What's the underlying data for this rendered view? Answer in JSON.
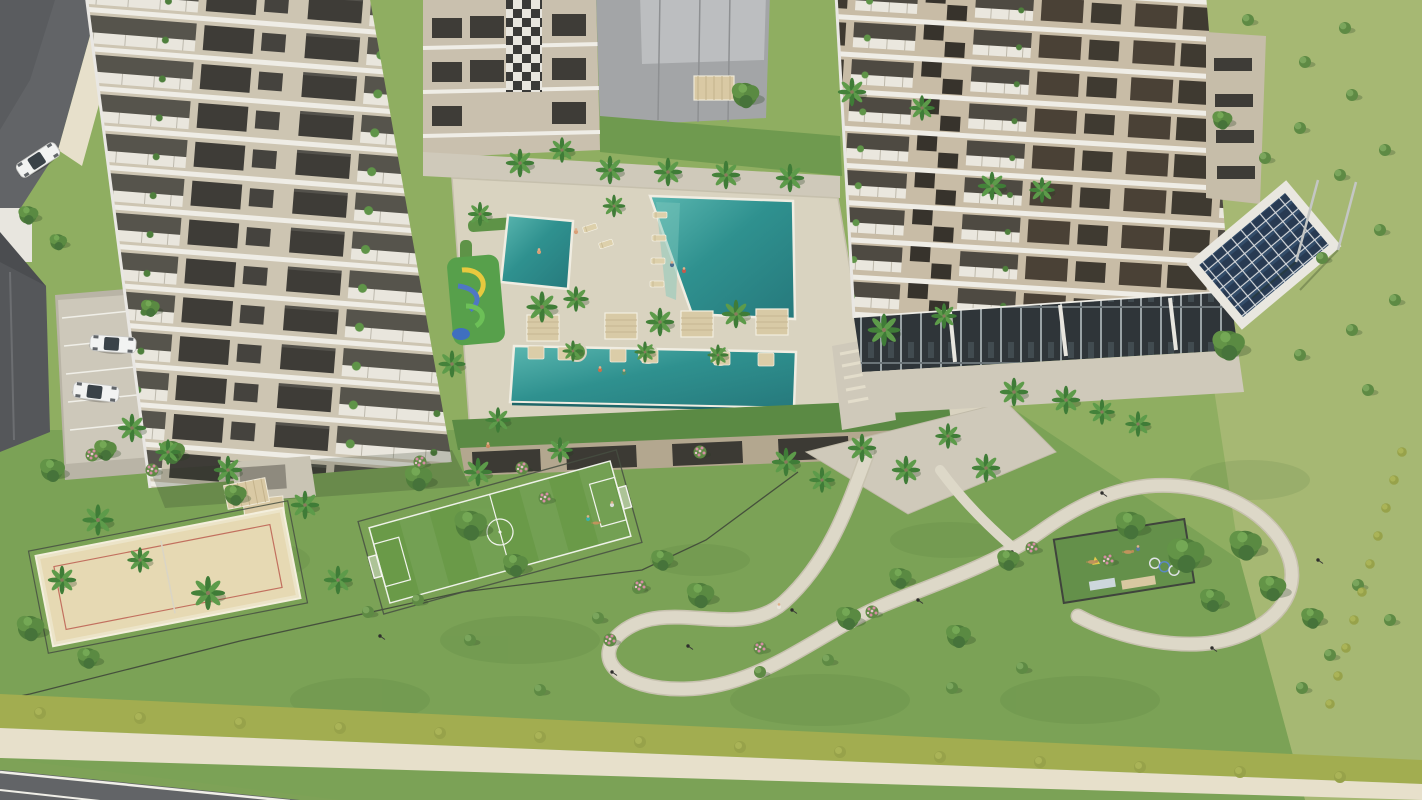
{
  "palette": {
    "grass_base": "#8fae61",
    "grass_light": "#a6b873",
    "grass_garden": "#7ba256",
    "field_green": "#6a9a48",
    "water_light": "#5bb7b0",
    "water_mid": "#2f918f",
    "water_deep": "#26797c",
    "deck": "#d9d3c0",
    "paving": "#cfc9ba",
    "sidewalk": "#e7e0cb",
    "asphalt": "#626467",
    "hedge": "#a2ad50",
    "sand": "#e6d9b3",
    "sand_line": "#c2705f",
    "facade_left": "#cdc5b2",
    "facade_right": "#c8bca6",
    "slab_white": "#efede6",
    "window_dark": "#3e3c37",
    "window_brown": "#4a4136",
    "roof_gray": "#a3a5a7",
    "solar_panel": "#283a52",
    "tan": "#d8caa6",
    "fence": "#474f42",
    "palm_green": "#3f7c37",
    "tree_green": "#4f7d3b",
    "flower_pink": "#d58da4",
    "car_white": "#f2f3f2"
  },
  "scene": {
    "description": "Aerial 3D render of a residential condominium: two beige apartment towers, pool deck with three turquoise pools and a kids water playground with rainbow slide, palm gardens, soccer field, beach volleyball court, dog park, winding walking path, rooftop solar panels and a perimeter road.",
    "vegetation": {
      "palms": [
        [
          520,
          163
        ],
        [
          562,
          150,
          0.9
        ],
        [
          610,
          170
        ],
        [
          668,
          172
        ],
        [
          726,
          175
        ],
        [
          790,
          178
        ],
        [
          992,
          186
        ],
        [
          1042,
          190,
          0.9
        ],
        [
          480,
          214,
          0.85
        ],
        [
          614,
          206,
          0.8
        ],
        [
          542,
          307,
          1.1
        ],
        [
          452,
          364,
          0.95
        ],
        [
          576,
          299,
          0.9
        ],
        [
          660,
          322
        ],
        [
          736,
          314
        ],
        [
          884,
          330,
          1.15
        ],
        [
          944,
          316,
          0.9
        ],
        [
          573,
          351,
          0.75
        ],
        [
          645,
          352,
          0.75
        ],
        [
          718,
          355,
          0.75
        ],
        [
          1014,
          392
        ],
        [
          1066,
          400
        ],
        [
          1102,
          412,
          0.9
        ],
        [
          1138,
          424,
          0.9
        ],
        [
          132,
          428
        ],
        [
          168,
          452,
          0.9
        ],
        [
          228,
          470
        ],
        [
          305,
          505
        ],
        [
          98,
          520,
          1.1
        ],
        [
          140,
          560,
          0.9
        ],
        [
          62,
          580
        ],
        [
          208,
          593,
          1.2
        ],
        [
          338,
          580
        ],
        [
          478,
          472
        ],
        [
          560,
          450,
          0.9
        ],
        [
          786,
          462
        ],
        [
          822,
          480,
          0.9
        ],
        [
          862,
          448
        ],
        [
          906,
          470
        ],
        [
          948,
          436,
          0.9
        ],
        [
          986,
          468
        ],
        [
          498,
          420,
          0.9
        ],
        [
          852,
          92
        ],
        [
          922,
          108,
          0.9
        ]
      ],
      "trees": [
        [
          52,
          470
        ],
        [
          105,
          450,
          0.9
        ],
        [
          172,
          452
        ],
        [
          235,
          495,
          0.9
        ],
        [
          418,
          478,
          1.1
        ],
        [
          470,
          525,
          1.3
        ],
        [
          515,
          565
        ],
        [
          700,
          595,
          1.1
        ],
        [
          662,
          560,
          0.9
        ],
        [
          848,
          618
        ],
        [
          900,
          578,
          0.9
        ],
        [
          958,
          636
        ],
        [
          1008,
          560,
          0.9
        ],
        [
          1130,
          525,
          1.2
        ],
        [
          1185,
          555,
          1.5
        ],
        [
          1245,
          545,
          1.3
        ],
        [
          1272,
          588,
          1.1
        ],
        [
          1212,
          600
        ],
        [
          1312,
          618,
          0.9
        ],
        [
          28,
          215,
          0.8
        ],
        [
          58,
          242,
          0.7
        ],
        [
          30,
          628,
          1.1
        ],
        [
          88,
          658,
          0.9
        ],
        [
          1228,
          345,
          1.3
        ],
        [
          745,
          95,
          1.1
        ],
        [
          1222,
          120,
          0.8
        ],
        [
          150,
          308,
          0.75
        ]
      ],
      "bushes": [
        [
          1248,
          20
        ],
        [
          1345,
          28
        ],
        [
          1305,
          62
        ],
        [
          1352,
          95
        ],
        [
          1300,
          128
        ],
        [
          1385,
          150
        ],
        [
          1340,
          175
        ],
        [
          1265,
          158
        ],
        [
          1380,
          230
        ],
        [
          1322,
          258
        ],
        [
          1395,
          300
        ],
        [
          1352,
          330
        ],
        [
          1300,
          355
        ],
        [
          1368,
          390
        ],
        [
          598,
          618
        ],
        [
          638,
          588
        ],
        [
          418,
          600
        ],
        [
          368,
          612
        ],
        [
          952,
          688
        ],
        [
          1022,
          668
        ],
        [
          760,
          672
        ],
        [
          828,
          660
        ],
        [
          1358,
          585
        ],
        [
          1390,
          620
        ],
        [
          1330,
          655
        ],
        [
          1302,
          688
        ],
        [
          470,
          640
        ],
        [
          540,
          690
        ]
      ],
      "flower_bushes": [
        [
          545,
          498
        ],
        [
          610,
          640
        ],
        [
          760,
          648
        ],
        [
          872,
          612
        ],
        [
          1032,
          548
        ],
        [
          700,
          452
        ],
        [
          640,
          586
        ],
        [
          1108,
          560
        ],
        [
          92,
          455
        ],
        [
          152,
          470
        ],
        [
          420,
          462
        ],
        [
          522,
          468
        ]
      ],
      "hedge_dots": [
        [
          40,
          713
        ],
        [
          140,
          718
        ],
        [
          240,
          723
        ],
        [
          340,
          728
        ],
        [
          440,
          733
        ],
        [
          540,
          737
        ],
        [
          640,
          742
        ],
        [
          740,
          747
        ],
        [
          840,
          752
        ],
        [
          940,
          757
        ],
        [
          1040,
          762
        ],
        [
          1140,
          767
        ],
        [
          1240,
          772
        ],
        [
          1340,
          777
        ],
        [
          1402,
          452,
          0.8
        ],
        [
          1394,
          480,
          0.8
        ],
        [
          1386,
          508,
          0.8
        ],
        [
          1378,
          536,
          0.8
        ],
        [
          1370,
          564,
          0.8
        ],
        [
          1362,
          592,
          0.8
        ],
        [
          1354,
          620,
          0.8
        ],
        [
          1346,
          648,
          0.8
        ],
        [
          1338,
          676,
          0.8
        ],
        [
          1330,
          704,
          0.8
        ]
      ]
    },
    "furniture": {
      "cabanas": [
        [
          543,
          328
        ],
        [
          621,
          326
        ],
        [
          697,
          324
        ],
        [
          772,
          322
        ]
      ],
      "loungers": [
        [
          660,
          215
        ],
        [
          659,
          238
        ],
        [
          658,
          261
        ],
        [
          657,
          284
        ],
        [
          590,
          228,
          1,
          -18
        ],
        [
          606,
          244,
          1,
          -18
        ]
      ],
      "pool_ledges": [
        [
          536,
          352
        ],
        [
          566,
          353
        ],
        [
          618,
          355
        ],
        [
          650,
          356
        ],
        [
          722,
          358
        ],
        [
          766,
          359
        ]
      ],
      "lamps": [
        [
          688,
          646
        ],
        [
          792,
          610
        ],
        [
          918,
          600
        ],
        [
          1012,
          552
        ],
        [
          1102,
          493
        ],
        [
          1212,
          648
        ],
        [
          612,
          672
        ],
        [
          380,
          636
        ],
        [
          1318,
          560
        ]
      ],
      "cars": [
        [
          38,
          160,
          1,
          -33
        ],
        [
          113,
          344,
          1,
          4
        ],
        [
          96,
          392,
          1,
          7
        ]
      ]
    },
    "actors": {
      "people": [
        [
          672,
          265,
          "#4d6e8f"
        ],
        [
          684,
          271,
          "#c25b4e"
        ],
        [
          600,
          370,
          "#c2714e"
        ],
        [
          624,
          373,
          "#4d8f6e"
        ],
        [
          576,
          232,
          "#d9a078"
        ],
        [
          539,
          252,
          "#d9a078"
        ],
        [
          779,
          607,
          "#e8e4da"
        ],
        [
          588,
          519,
          "#3bb0a0"
        ],
        [
          612,
          505,
          "#dcdcda"
        ],
        [
          1138,
          549,
          "#5a7d9a"
        ],
        [
          488,
          446,
          "#c98a5e"
        ]
      ],
      "dogs": [
        [
          1092,
          562
        ],
        [
          1128,
          552
        ],
        [
          596,
          523,
          0.8
        ]
      ]
    }
  }
}
